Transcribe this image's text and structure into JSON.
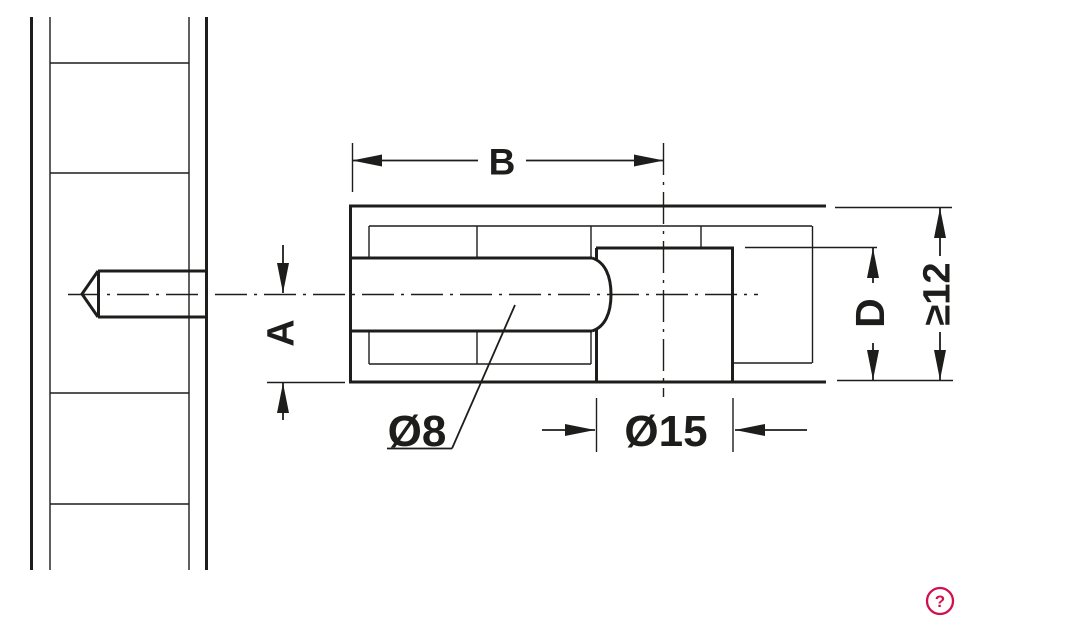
{
  "colors": {
    "line": "#1d1d1b",
    "background": "#ffffff",
    "accent": "#d1114d"
  },
  "drawing": {
    "title": "connecting-bolt-technical-drawing",
    "labels": [
      {
        "name": "dim-label-b",
        "text": "B",
        "x": 502,
        "y": 161,
        "rotate": 0,
        "size": 37,
        "bg": [
          478,
          144,
          48,
          34
        ]
      },
      {
        "name": "dim-label-a",
        "text": "A",
        "x": 280,
        "y": 333,
        "rotate": -90,
        "size": 38,
        "bg": null
      },
      {
        "name": "dim-label-dia8",
        "text": "Ø8",
        "x": 417,
        "y": 430,
        "rotate": 0,
        "size": 44,
        "bg": null
      },
      {
        "name": "dim-label-dia15",
        "text": "Ø15",
        "x": 666,
        "y": 430,
        "rotate": 0,
        "size": 44,
        "bg": null
      },
      {
        "name": "dim-label-d",
        "text": "D",
        "x": 869,
        "y": 313,
        "rotate": -90,
        "size": 41,
        "bg": [
          849,
          283,
          40,
          60
        ]
      },
      {
        "name": "dim-label-min12",
        "text": "≥12",
        "x": 936,
        "y": 294,
        "rotate": -90,
        "size": 38,
        "bg": [
          916,
          256,
          40,
          76
        ]
      }
    ],
    "thick_lines": [
      [
        31.5,
        17,
        31.5,
        570
      ],
      [
        206.5,
        17,
        206.5,
        570
      ],
      [
        98,
        271,
        206,
        271
      ],
      [
        98,
        317,
        206,
        317
      ],
      [
        98.5,
        271,
        98.5,
        317
      ],
      [
        350,
        206,
        826,
        206
      ],
      [
        350,
        382,
        826,
        382
      ],
      [
        350.5,
        204.5,
        350.5,
        383.5
      ],
      [
        350,
        258,
        592,
        258
      ],
      [
        350,
        331,
        592,
        331
      ],
      [
        596,
        248,
        733,
        248
      ],
      [
        596.5,
        248,
        596.5,
        259
      ],
      [
        596.5,
        330,
        596.5,
        382
      ],
      [
        732.5,
        246.5,
        732.5,
        382
      ]
    ],
    "thin_lines": [
      [
        50,
        17,
        50,
        570
      ],
      [
        189,
        17,
        189,
        570
      ],
      [
        50,
        63,
        189,
        63
      ],
      [
        50,
        173,
        189,
        173
      ],
      [
        50,
        393,
        189,
        393
      ],
      [
        50,
        504,
        189,
        504
      ],
      [
        369,
        226,
        812,
        226
      ],
      [
        369,
        226,
        369,
        258
      ],
      [
        369,
        331,
        369,
        364
      ],
      [
        477,
        226,
        477,
        258
      ],
      [
        477,
        331,
        477,
        364
      ],
      [
        591,
        226,
        591,
        258
      ],
      [
        591,
        331,
        591,
        364
      ],
      [
        369,
        364,
        591,
        364
      ],
      [
        733,
        363,
        812,
        363
      ],
      [
        701,
        226,
        701,
        248
      ],
      [
        812.5,
        226,
        812.5,
        363
      ],
      [
        745,
        247.5,
        877,
        247.5
      ],
      [
        835,
        207.5,
        952,
        207.5
      ],
      [
        837,
        380.5,
        953,
        380.5
      ],
      [
        267,
        382.5,
        345,
        382.5
      ],
      [
        352.5,
        143,
        352.5,
        192
      ],
      [
        596.5,
        398,
        596.5,
        452
      ],
      [
        733,
        398,
        733,
        452
      ]
    ],
    "dim_lines": [
      [
        352,
        160.5,
        664,
        160.5
      ],
      [
        283,
        245,
        283,
        293
      ],
      [
        283,
        383,
        283,
        420
      ],
      [
        873,
        248,
        873,
        380
      ],
      [
        940,
        208,
        940,
        380
      ],
      [
        542,
        430,
        595,
        430
      ],
      [
        735,
        430,
        807,
        430
      ],
      [
        387,
        448.5,
        452,
        448.5
      ],
      [
        452,
        448.5,
        515,
        305
      ]
    ],
    "centerlines": [
      [
        68,
        294.5,
        758,
        294.5
      ],
      [
        663.5,
        143,
        663.5,
        397
      ]
    ],
    "arrows": [
      {
        "x": 352,
        "y": 160.5,
        "dir": "left"
      },
      {
        "x": 664,
        "y": 160.5,
        "dir": "right"
      },
      {
        "x": 283,
        "y": 293,
        "dir": "down"
      },
      {
        "x": 283,
        "y": 383,
        "dir": "up"
      },
      {
        "x": 873,
        "y": 248,
        "dir": "up"
      },
      {
        "x": 873,
        "y": 380,
        "dir": "down"
      },
      {
        "x": 940,
        "y": 208,
        "dir": "up"
      },
      {
        "x": 940,
        "y": 380,
        "dir": "down"
      },
      {
        "x": 595,
        "y": 430,
        "dir": "right"
      },
      {
        "x": 735,
        "y": 430,
        "dir": "left"
      }
    ],
    "bolt_tip": "98,271 82,294 98,317",
    "shaft_cap": "M592,258 C605,262 611,276 611,294.5 C611,313 605,327 592,331"
  },
  "help": {
    "symbol": "?",
    "cx": 940,
    "cy": 601,
    "r": 13
  }
}
